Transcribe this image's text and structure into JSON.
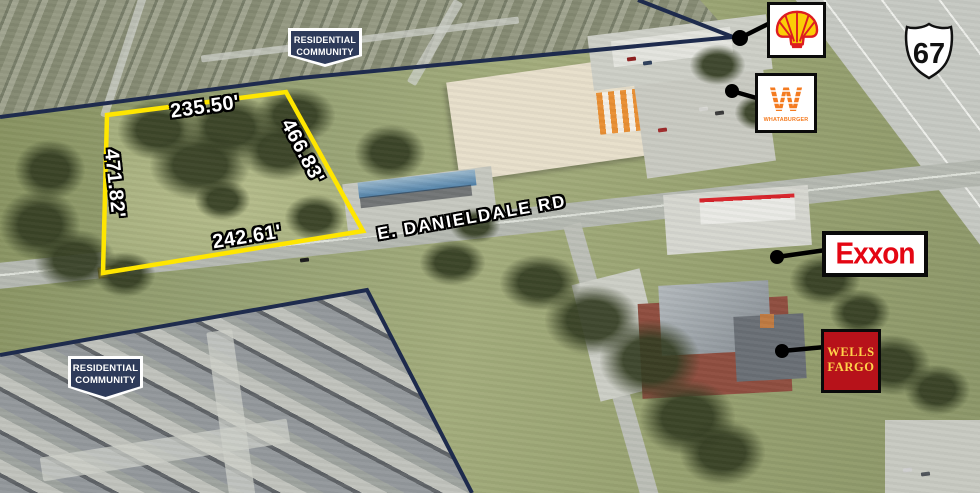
{
  "badges": {
    "top": {
      "line1": "RESIDENTIAL",
      "line2": "COMMUNITY"
    },
    "bottom": {
      "line1": "RESIDENTIAL",
      "line2": "COMMUNITY"
    }
  },
  "parcel": {
    "dim_top": "235.50'",
    "dim_right": "466.83'",
    "dim_left": "471.82'",
    "dim_bottom": "242.61'",
    "outline_color": "#ffe600"
  },
  "road": {
    "label": "E. DANIELDALE RD"
  },
  "highway": {
    "route_number": "67"
  },
  "businesses": {
    "shell": {
      "icon": "shell-pecten-logo"
    },
    "whataburger": {
      "name": "WHATABURGER"
    },
    "exxon": {
      "name": "Exxon"
    },
    "wells_fargo": {
      "line1": "WELLS",
      "line2": "FARGO"
    }
  },
  "colors": {
    "boundary_navy": "#1e2b4d",
    "parcel_yellow": "#ffe600",
    "callout_black": "#000000",
    "shell_red": "#dd1d21",
    "shell_yellow": "#fbce07",
    "whataburger_orange": "#f47b20",
    "exxon_red": "#e40613",
    "wells_red": "#b7121a",
    "wells_yellow": "#ffd24a"
  }
}
